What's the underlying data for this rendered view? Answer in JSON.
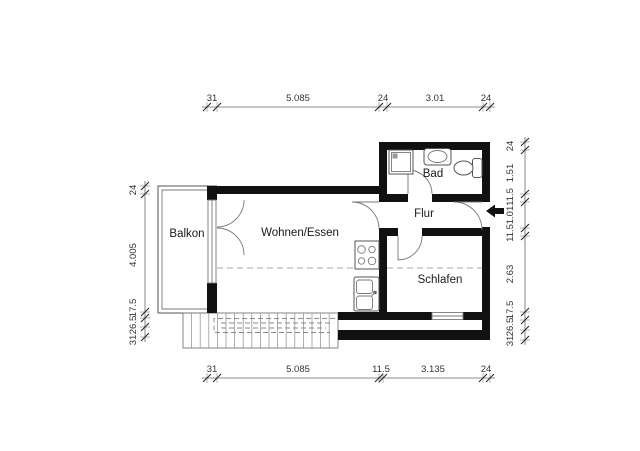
{
  "plan": {
    "type": "floor-plan",
    "language": "de"
  },
  "rooms": {
    "balkon": "Balkon",
    "wohnen": "Wohnen/Essen",
    "flur": "Flur",
    "bad": "Bad",
    "schlafen": "Schlafen"
  },
  "dimensions": {
    "top": [
      "31",
      "5.085",
      "24",
      "3.01",
      "24"
    ],
    "bottom": [
      "31",
      "5.085",
      "11.5",
      "3.135",
      "24"
    ],
    "left": [
      "24",
      "4.005",
      "17.5",
      "26.5",
      "31"
    ],
    "right": [
      "24",
      "1.51",
      "11.5",
      "1.01",
      "11.5",
      "2.63",
      "17.5",
      "26.5",
      "31"
    ]
  },
  "icons": {
    "entrance_arrow": "left-arrow",
    "stairs": "tread-lines-with-dashed-walkline",
    "shower": "square-with-drain",
    "washbasin": "oval-in-rounded-rect",
    "toilet": "oval-with-cistern",
    "stove": "four-burner-circles",
    "kitchen_sink": "double-basin-with-faucet"
  },
  "colors": {
    "wall": "#111111",
    "line": "#555555",
    "dashed": "#aaaaaa",
    "dimension": "#666666",
    "text": "#1a1a1a",
    "background": "#ffffff"
  }
}
